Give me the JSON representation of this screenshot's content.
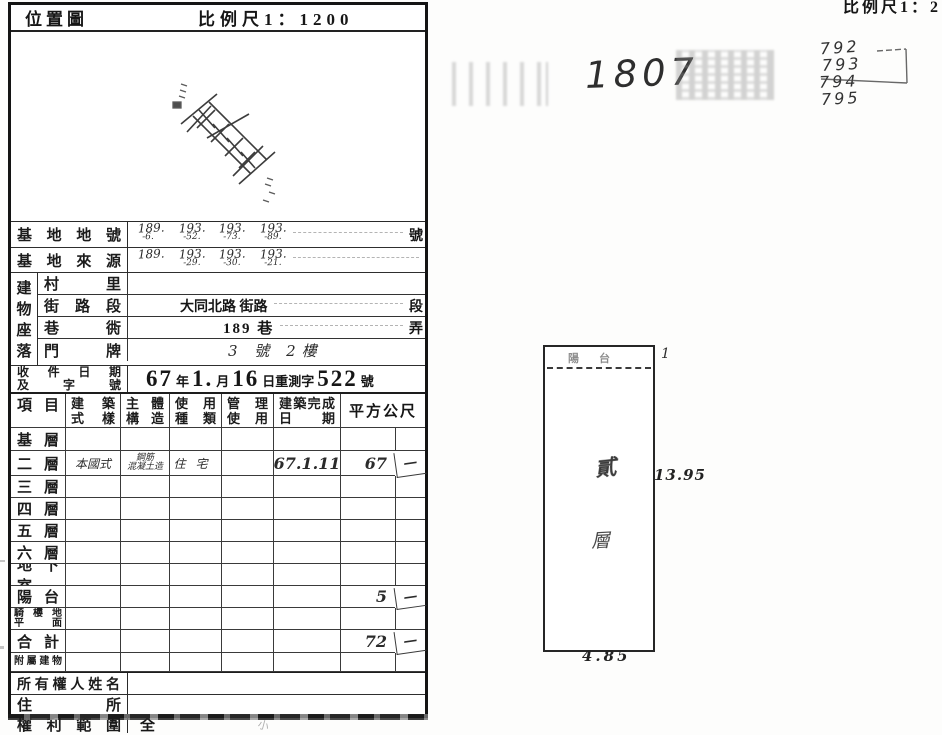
{
  "header": {
    "location_map": "位置圖",
    "scale": "比例尺1：1200"
  },
  "corner_scale": "比例尺1：2",
  "site": {
    "lot_label": "基地地號",
    "lot_suffix": "號",
    "lot_parts": [
      {
        "top": "189.",
        "bottom": "-6."
      },
      {
        "top": "193.",
        "bottom": "-52."
      },
      {
        "top": "193.",
        "bottom": "-73."
      },
      {
        "top": "193.",
        "bottom": "-89."
      }
    ],
    "source_label": "基地來源",
    "source_parts": [
      {
        "top": "189.",
        "bottom": ""
      },
      {
        "top": "193.",
        "bottom": "-29."
      },
      {
        "top": "193.",
        "bottom": "-30."
      },
      {
        "top": "193.",
        "bottom": "-21."
      }
    ]
  },
  "location": {
    "vertical_label": "建物座落",
    "rows": [
      {
        "label": "村里",
        "value": "",
        "suffix": ""
      },
      {
        "label": "街路段",
        "value": "大同北路 街路",
        "suffix": "段"
      },
      {
        "label": "巷衖",
        "value": "189 巷",
        "suffix": "弄"
      },
      {
        "label": "門牌",
        "value": "3 號 2樓",
        "suffix": ""
      }
    ]
  },
  "receipt": {
    "label_line1": "收件日期",
    "label_line2": "及字號",
    "n1": "67",
    "u1": "年",
    "n2": "1.",
    "u2": "月",
    "n3": "16",
    "u3": "日重測字",
    "n4": "522",
    "u4": "號"
  },
  "floor_table": {
    "headers": {
      "item": "項目",
      "style_l1": "建築",
      "style_l2": "式樣",
      "struct_l1": "主體",
      "struct_l2": "構造",
      "use_l1": "使用",
      "use_l2": "種類",
      "mgmt_l1": "管理",
      "mgmt_l2": "使用",
      "date_l1": "建築完成",
      "date_l2": "日期",
      "area": "平方公尺"
    },
    "rows": [
      {
        "label": "基層"
      },
      {
        "label": "二層",
        "style": "本國式",
        "struct1": "鋼筋",
        "struct2": "混凝土造",
        "use": "住宅",
        "date": "67.1.11",
        "area": "67",
        "extra": "—"
      },
      {
        "label": "三層"
      },
      {
        "label": "四層"
      },
      {
        "label": "五層"
      },
      {
        "label": "六層"
      },
      {
        "label": "地下室"
      },
      {
        "label": "陽台",
        "area": "5",
        "extra": "—"
      },
      {
        "label": "騎樓地",
        "label2": "平面"
      },
      {
        "label": "合計",
        "area": "72",
        "extra": "—"
      },
      {
        "label": "附屬建物"
      }
    ]
  },
  "owner": {
    "name_label": "所有權人姓名",
    "addr_label": "住所",
    "rights_label": "權利範圍",
    "rights_value": "全"
  },
  "annotations": {
    "stamp_number": "1807",
    "pencil_numbers": [
      "792",
      "793",
      "794",
      "795"
    ]
  },
  "plan": {
    "balcony_label": "陽台",
    "balcony_depth": "1",
    "height": "13.95",
    "width": "4.85",
    "floor_char1": "貳",
    "floor_char2": "層"
  }
}
